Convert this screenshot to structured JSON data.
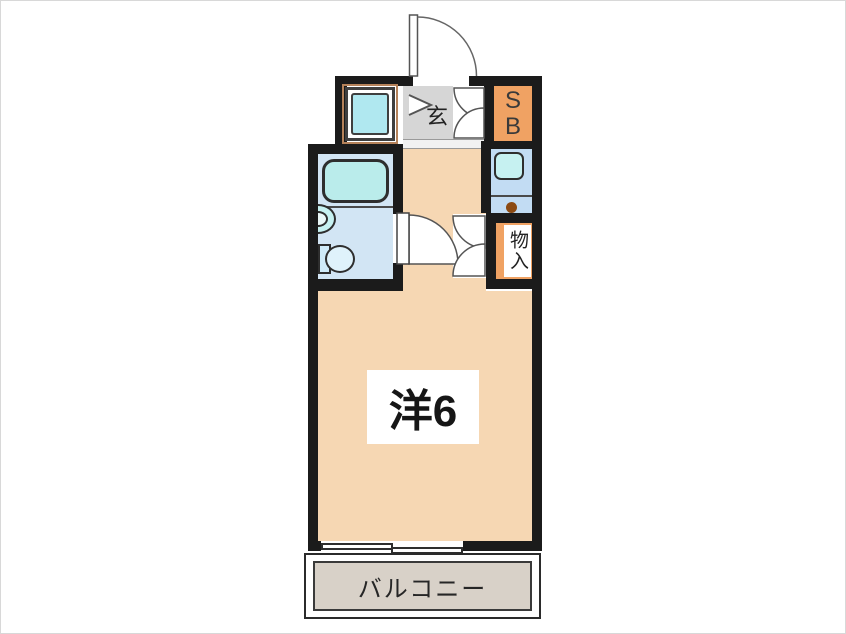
{
  "labels": {
    "entrance": "玄",
    "shoe_box": "SB",
    "storage": "物入",
    "main_room": "洋6",
    "balcony": "バルコニー"
  },
  "colors": {
    "wall": "#1b1b1b",
    "room_floor": "#f6d7b3",
    "entrance_floor": "#d6d6d6",
    "bathroom_floor": "#d2e5f4",
    "bathtub": "#baeceb",
    "kitchen_counter": "#c2dcf3",
    "kitchen_sink": "#c6f1f1",
    "cabinet_orange": "#f0a263",
    "balcony_floor": "#d8d1c8",
    "washer_pan": "#b0e8f0",
    "burner_dot": "#8c4a12"
  }
}
